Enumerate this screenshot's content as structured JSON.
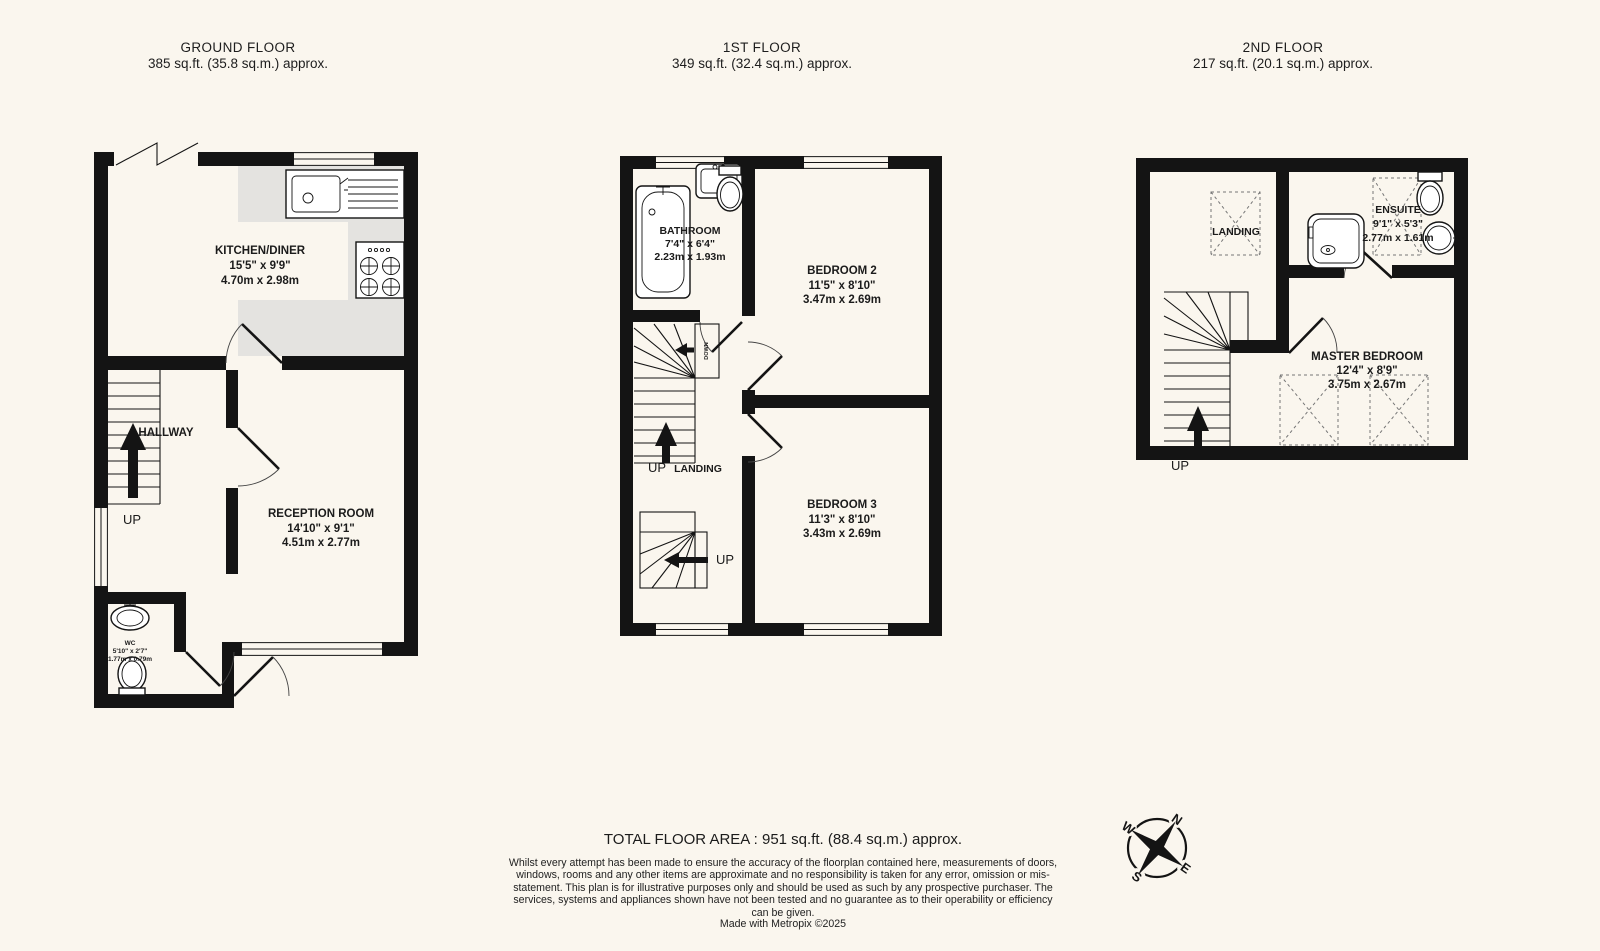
{
  "floors": {
    "ground": {
      "title": "GROUND FLOOR",
      "area": "385 sq.ft. (35.8 sq.m.) approx.",
      "kitchen": {
        "name": "KITCHEN/DINER",
        "imperial": "15'5\"  x 9'9\"",
        "metric": "4.70m  x 2.98m"
      },
      "hallway": "HALLWAY",
      "up": "UP",
      "reception": {
        "name": "RECEPTION ROOM",
        "imperial": "14'10\"  x 9'1\"",
        "metric": "4.51m  x 2.77m"
      },
      "wc": {
        "name": "WC",
        "imperial": "5'10\"  x 2'7\"",
        "metric": "1.77m  x 0.79m"
      }
    },
    "first": {
      "title": "1ST FLOOR",
      "area": "349 sq.ft. (32.4 sq.m.) approx.",
      "bathroom": {
        "name": "BATHROOM",
        "imperial": "7'4\"  x 6'4\"",
        "metric": "2.23m  x 1.93m"
      },
      "bedroom2": {
        "name": "BEDROOM 2",
        "imperial": "11'5\"  x 8'10\"",
        "metric": "3.47m  x 2.69m"
      },
      "bedroom3": {
        "name": "BEDROOM 3",
        "imperial": "11'3\"  x 8'10\"",
        "metric": "3.43m  x 2.69m"
      },
      "down": "DOWN",
      "up": "UP",
      "landing": "LANDING",
      "up2": "UP"
    },
    "second": {
      "title": "2ND FLOOR",
      "area": "217 sq.ft. (20.1 sq.m.) approx.",
      "landing": "LANDING",
      "ensuite": {
        "name": "ENSUITE",
        "imperial": "9'1\"  x 5'3\"",
        "metric": "2.77m  x 1.61m"
      },
      "master": {
        "name": "MASTER BEDROOM",
        "imperial": "12'4\"  x 8'9\"",
        "metric": "3.75m  x 2.67m"
      },
      "up": "UP"
    }
  },
  "footer": {
    "total": "TOTAL FLOOR AREA : 951 sq.ft. (88.4 sq.m.) approx.",
    "disclaimer": "Whilst every attempt has been made to ensure the accuracy of the floorplan contained here, measurements of doors, windows, rooms and any other items are approximate and no responsibility is taken for any error, omission or mis-statement. This plan is for illustrative purposes only and should be used as such by any prospective purchaser. The services, systems and appliances shown have not been tested and no guarantee as to their operability or efficiency can be given.",
    "credit": "Made with Metropix ©2025"
  },
  "compass": {
    "north": "N",
    "east": "E",
    "south": "S",
    "west": "W"
  }
}
